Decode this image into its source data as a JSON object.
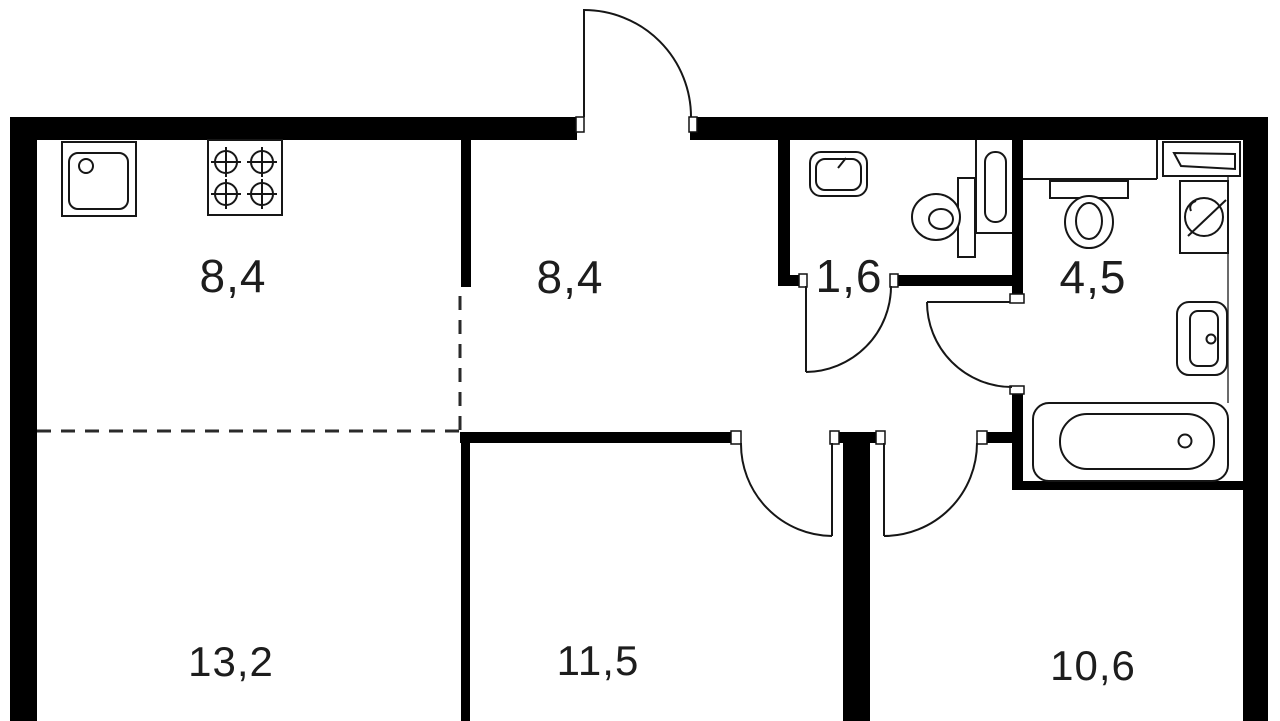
{
  "plan": {
    "type": "apartment-floor-plan",
    "colors": {
      "background": "#ffffff",
      "walls": "#000000",
      "fixture_lines": "#161616",
      "labels": "#1d1d1d"
    },
    "rooms": [
      {
        "name": "kitchen-living",
        "area": "8,4"
      },
      {
        "name": "hallway",
        "area": "8,4"
      },
      {
        "name": "wc",
        "area": "1,6"
      },
      {
        "name": "bathroom",
        "area": "4,5"
      },
      {
        "name": "living-room",
        "area": "13,2"
      },
      {
        "name": "bedroom",
        "area": "11,5"
      },
      {
        "name": "bedroom-2",
        "area": "10,6"
      }
    ],
    "fixtures": [
      {
        "icon": "kitchen-sink-icon",
        "room": "kitchen-living"
      },
      {
        "icon": "stove-icon",
        "room": "kitchen-living"
      },
      {
        "icon": "washbasin-icon",
        "room": "wc"
      },
      {
        "icon": "toilet-icon",
        "room": "wc"
      },
      {
        "icon": "heated-towel-rail-icon",
        "room": "wc"
      },
      {
        "icon": "toilet-icon",
        "room": "bathroom"
      },
      {
        "icon": "washing-machine-icon",
        "room": "bathroom"
      },
      {
        "icon": "shelf-icon",
        "room": "bathroom"
      },
      {
        "icon": "washbasin-icon",
        "room": "bathroom"
      },
      {
        "icon": "bathtub-icon",
        "room": "bathroom"
      }
    ],
    "doors": [
      {
        "name": "entrance-door",
        "location": "top-wall"
      },
      {
        "name": "wc-door",
        "location": "wc"
      },
      {
        "name": "bathroom-door",
        "location": "bathroom"
      },
      {
        "name": "bedroom-door",
        "location": "bedroom"
      },
      {
        "name": "bedroom-2-door",
        "location": "bedroom-2"
      }
    ]
  }
}
